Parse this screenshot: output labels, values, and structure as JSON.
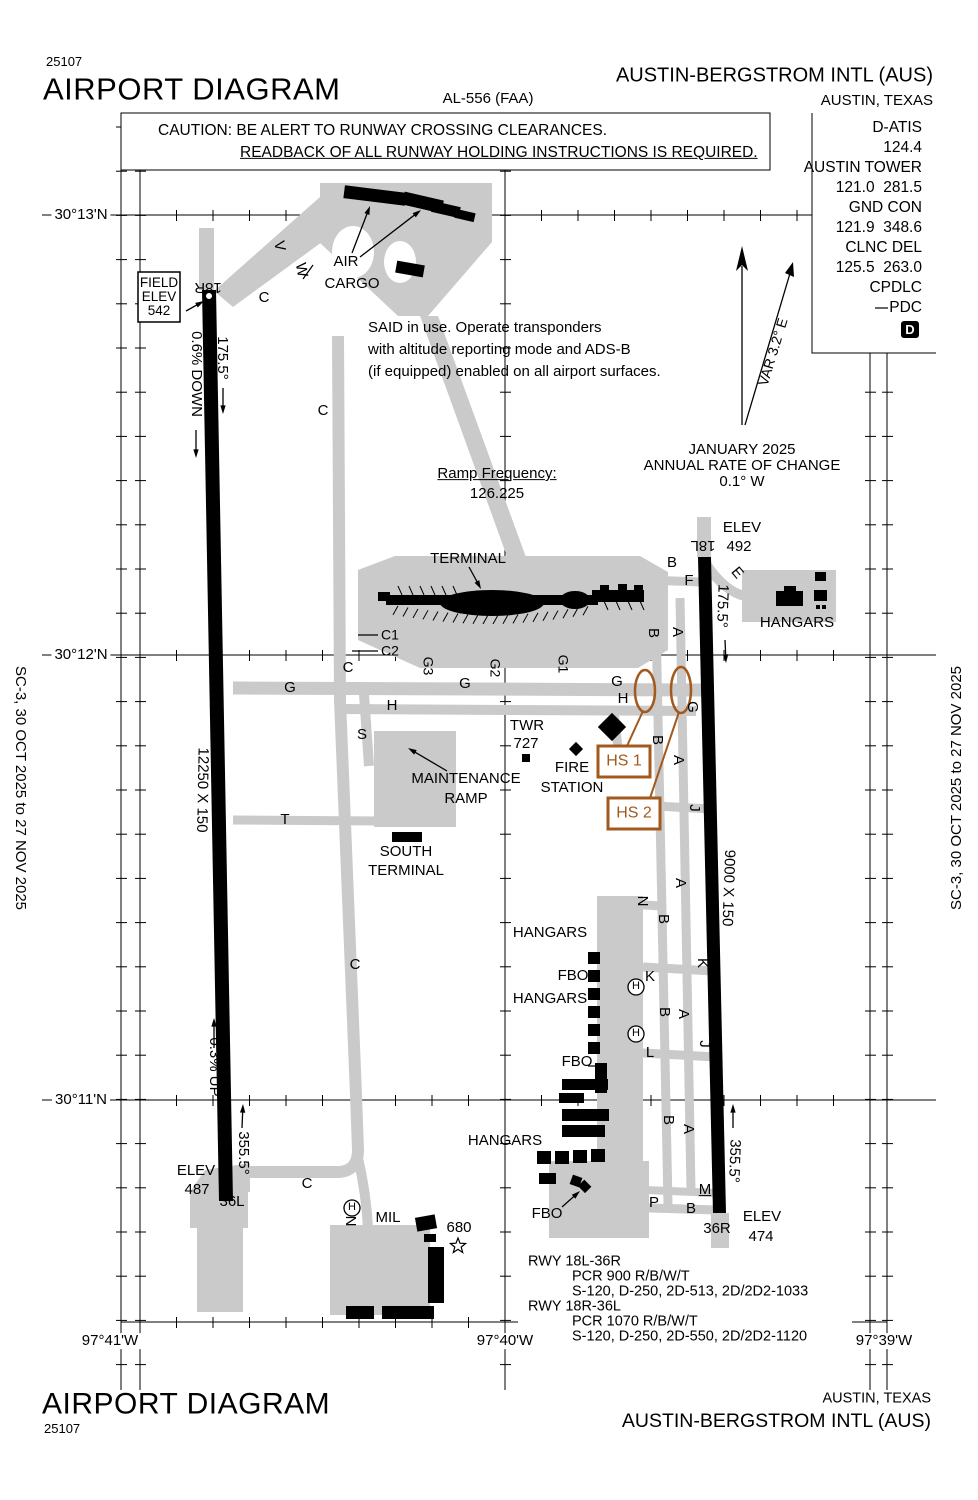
{
  "header": {
    "chart_number": "25107",
    "title": "AIRPORT DIAGRAM",
    "procedure_id": "AL-556 (FAA)",
    "airport_name": "AUSTIN-BERGSTROM INTL (AUS)",
    "city_state": "AUSTIN, TEXAS"
  },
  "footer": {
    "title": "AIRPORT DIAGRAM",
    "chart_number": "25107",
    "airport_name": "AUSTIN-BERGSTROM INTL (AUS)",
    "city_state": "AUSTIN, TEXAS"
  },
  "margins": {
    "left_edition": "SC-3, 30 OCT 2025 to 27 NOV 2025",
    "right_edition": "SC-3, 30 OCT 2025 to 27 NOV 2025"
  },
  "frequencies": {
    "lines": [
      "D-ATIS",
      "124.4",
      "AUSTIN TOWER",
      "121.0  281.5",
      "GND CON",
      "121.9  348.6",
      "CLNC DEL",
      "125.5  263.0",
      "CPDLC",
      "PDC"
    ]
  },
  "rwy_info": {
    "lines": [
      {
        "t": "RWY 18L-36R",
        "i": 0
      },
      {
        "t": "PCR 900 R/B/W/T",
        "i": 1
      },
      {
        "t": "S-120, D-250, 2D-513, 2D/2D2-1033",
        "i": 1
      },
      {
        "t": "RWY 18R-36L",
        "i": 0
      },
      {
        "t": "PCR 1070 R/B/W/T",
        "i": 1
      },
      {
        "t": "S-120, D-250, 2D-550, 2D/2D2-1120",
        "i": 1
      }
    ]
  },
  "colors": {
    "hotspot": "#a3581c",
    "taxiway_gray": "#cacaca",
    "black": "#000000"
  },
  "map": {
    "labels": [
      {
        "n": "lat-label-30-13n",
        "t": "30°13'N",
        "x": 81,
        "y": 215,
        "bg": 1
      },
      {
        "n": "lat-label-30-12n",
        "t": "30°12'N",
        "x": 81,
        "y": 655,
        "bg": 1
      },
      {
        "n": "lat-label-30-11n",
        "t": "30°11'N",
        "x": 81,
        "y": 1100,
        "bg": 1
      },
      {
        "n": "lon-label-97-41w",
        "t": "97°41'W",
        "x": 110,
        "y": 1341,
        "bg": 1
      },
      {
        "n": "lon-label-97-40w",
        "t": "97°40'W",
        "x": 505,
        "y": 1341,
        "bg": 1
      },
      {
        "n": "lon-label-97-39w",
        "t": "97°39'W",
        "x": 884,
        "y": 1341,
        "bg": 1
      },
      {
        "n": "caution-line-1",
        "t": "CAUTION: BE ALERT TO RUNWAY CROSSING CLEARANCES.",
        "x": 158,
        "y": 131,
        "a": "l",
        "fs": 15.5
      },
      {
        "n": "caution-line-2",
        "t": "READBACK OF ALL RUNWAY HOLDING INSTRUCTIONS IS REQUIRED.",
        "x": 240,
        "y": 153,
        "a": "l",
        "fs": 15.5,
        "u": 1
      },
      {
        "n": "pdc-d-letter",
        "t": "D",
        "x": 910,
        "y": 330,
        "fs": 13,
        "col": "#ffffff",
        "b": 1
      },
      {
        "n": "field-elev-line-1",
        "t": "FIELD",
        "x": 159,
        "y": 283,
        "fs": 13.5
      },
      {
        "n": "field-elev-line-2",
        "t": "ELEV",
        "x": 159,
        "y": 297,
        "fs": 13.5
      },
      {
        "n": "field-elev-line-3",
        "t": "542",
        "x": 159,
        "y": 311,
        "fs": 13.5
      },
      {
        "n": "rwy-end-18r",
        "t": "18R",
        "x": 208,
        "y": 287,
        "r": 180
      },
      {
        "n": "slope-label-06-down",
        "t": "0.6% DOWN",
        "x": 196,
        "y": 374,
        "r": 90
      },
      {
        "n": "hdg-label-175-5-west",
        "t": "175.5°",
        "x": 222,
        "y": 358,
        "r": 90
      },
      {
        "n": "air-cargo-line-1",
        "t": "AIR",
        "x": 346,
        "y": 262
      },
      {
        "n": "air-cargo-line-2",
        "t": "CARGO",
        "x": 352,
        "y": 284
      },
      {
        "n": "said-note-line-1",
        "t": "SAID in use. Operate transponders",
        "x": 368,
        "y": 328,
        "a": "l"
      },
      {
        "n": "said-note-line-2",
        "t": "with altitude reporting mode and ADS-B",
        "x": 368,
        "y": 350,
        "a": "l"
      },
      {
        "n": "said-note-line-3",
        "t": "(if equipped) enabled on all airport surfaces.",
        "x": 368,
        "y": 372,
        "a": "l"
      },
      {
        "n": "ramp-frequency-label",
        "t": "Ramp Frequency:",
        "x": 497,
        "y": 474,
        "u": 1
      },
      {
        "n": "ramp-frequency-value",
        "t": "126.225",
        "x": 497,
        "y": 494
      },
      {
        "n": "annual-change-line-1",
        "t": "JANUARY 2025",
        "x": 742,
        "y": 450
      },
      {
        "n": "annual-change-line-2",
        "t": "ANNUAL RATE OF CHANGE",
        "x": 742,
        "y": 466
      },
      {
        "n": "annual-change-line-3",
        "t": "0.1° W",
        "x": 742,
        "y": 482
      },
      {
        "n": "var-label",
        "t": "VAR 3.2° E",
        "x": 773,
        "y": 352,
        "r": -73,
        "fs": 14
      },
      {
        "n": "terminal-label",
        "t": "TERMINAL",
        "x": 468,
        "y": 559
      },
      {
        "n": "elev-18l-line-1",
        "t": "ELEV",
        "x": 742,
        "y": 528
      },
      {
        "n": "elev-18l-line-2",
        "t": "492",
        "x": 739,
        "y": 547
      },
      {
        "n": "rwy-end-18l",
        "t": "18L",
        "x": 703,
        "y": 545,
        "r": 180
      },
      {
        "n": "hdg-label-175-5-east",
        "t": "175.5°",
        "x": 722,
        "y": 606,
        "r": 92
      },
      {
        "n": "hangars-ne-label",
        "t": "HANGARS",
        "x": 797,
        "y": 623
      },
      {
        "n": "taxiway-label-v",
        "t": "V",
        "x": 279,
        "y": 246,
        "r": 80
      },
      {
        "n": "taxiway-label-w",
        "t": "W",
        "x": 301,
        "y": 270,
        "r": 80
      },
      {
        "n": "taxiway-label-c-1",
        "t": "C",
        "x": 264,
        "y": 298
      },
      {
        "n": "taxiway-label-c-2",
        "t": "C",
        "x": 323,
        "y": 411
      },
      {
        "n": "taxiway-label-c-3",
        "t": "C",
        "x": 348,
        "y": 668
      },
      {
        "n": "taxiway-label-c-4",
        "t": "C",
        "x": 355,
        "y": 965
      },
      {
        "n": "taxiway-label-c-5",
        "t": "C",
        "x": 307,
        "y": 1184
      },
      {
        "n": "taxiway-label-c1",
        "t": "C1",
        "x": 390,
        "y": 635,
        "fs": 14
      },
      {
        "n": "taxiway-label-c2",
        "t": "C2",
        "x": 390,
        "y": 651,
        "fs": 14
      },
      {
        "n": "taxiway-label-g3",
        "t": "G3",
        "x": 428,
        "y": 666,
        "r": 90,
        "fs": 14
      },
      {
        "n": "taxiway-label-g2",
        "t": "G2",
        "x": 495,
        "y": 668,
        "r": 90,
        "fs": 14
      },
      {
        "n": "taxiway-label-g1",
        "t": "G1",
        "x": 563,
        "y": 664,
        "r": 90,
        "fs": 14
      },
      {
        "n": "taxiway-label-g-1",
        "t": "G",
        "x": 290,
        "y": 688
      },
      {
        "n": "taxiway-label-g-2",
        "t": "G",
        "x": 465,
        "y": 684
      },
      {
        "n": "taxiway-label-g-3",
        "t": "G",
        "x": 617,
        "y": 682
      },
      {
        "n": "taxiway-label-g-4",
        "t": "G",
        "x": 692,
        "y": 707,
        "r": 90
      },
      {
        "n": "taxiway-label-h-1",
        "t": "H",
        "x": 392,
        "y": 706
      },
      {
        "n": "taxiway-label-h-2",
        "t": "H",
        "x": 623,
        "y": 699
      },
      {
        "n": "taxiway-label-s",
        "t": "S",
        "x": 362,
        "y": 735
      },
      {
        "n": "taxiway-label-t",
        "t": "T",
        "x": 285,
        "y": 820
      },
      {
        "n": "taxiway-label-b-1",
        "t": "B",
        "x": 672,
        "y": 563
      },
      {
        "n": "taxiway-label-f",
        "t": "F",
        "x": 689,
        "y": 581
      },
      {
        "n": "taxiway-label-e",
        "t": "E",
        "x": 737,
        "y": 573,
        "r": 50
      },
      {
        "n": "taxiway-label-b-2",
        "t": "B",
        "x": 653,
        "y": 633,
        "r": 90
      },
      {
        "n": "taxiway-label-a-1",
        "t": "A",
        "x": 677,
        "y": 632,
        "r": 90
      },
      {
        "n": "taxiway-label-b-3",
        "t": "B",
        "x": 657,
        "y": 740,
        "r": 90
      },
      {
        "n": "taxiway-label-a-2",
        "t": "A",
        "x": 678,
        "y": 760,
        "r": 90
      },
      {
        "n": "taxiway-label-j-1",
        "t": "J",
        "x": 694,
        "y": 808,
        "r": 90
      },
      {
        "n": "taxiway-label-a-3",
        "t": "A",
        "x": 680,
        "y": 883,
        "r": 90
      },
      {
        "n": "taxiway-label-n-1",
        "t": "N",
        "x": 642,
        "y": 901,
        "r": 90
      },
      {
        "n": "taxiway-label-b-4",
        "t": "B",
        "x": 663,
        "y": 919,
        "r": 90
      },
      {
        "n": "taxiway-label-k-1",
        "t": "K",
        "x": 702,
        "y": 963,
        "r": 90
      },
      {
        "n": "taxiway-label-k-2",
        "t": "K",
        "x": 650,
        "y": 977
      },
      {
        "n": "taxiway-label-b-5",
        "t": "B",
        "x": 664,
        "y": 1012,
        "r": 90
      },
      {
        "n": "taxiway-label-a-4",
        "t": "A",
        "x": 683,
        "y": 1014,
        "r": 90
      },
      {
        "n": "taxiway-label-j-2",
        "t": "J",
        "x": 704,
        "y": 1044,
        "r": 90
      },
      {
        "n": "taxiway-label-l",
        "t": "L",
        "x": 650,
        "y": 1053
      },
      {
        "n": "taxiway-label-b-6",
        "t": "B",
        "x": 668,
        "y": 1120,
        "r": 90
      },
      {
        "n": "taxiway-label-a-5",
        "t": "A",
        "x": 688,
        "y": 1129,
        "r": 90
      },
      {
        "n": "taxiway-label-n-2",
        "t": "N",
        "x": 350,
        "y": 1221,
        "r": 90
      },
      {
        "n": "taxiway-label-m",
        "t": "M",
        "x": 705,
        "y": 1190,
        "u": 1
      },
      {
        "n": "taxiway-label-p",
        "t": "P",
        "x": 654,
        "y": 1203
      },
      {
        "n": "taxiway-label-b-7",
        "t": "B",
        "x": 691,
        "y": 1209
      },
      {
        "n": "twr-label",
        "t": "TWR",
        "x": 527,
        "y": 726
      },
      {
        "n": "twr-elev",
        "t": "727",
        "x": 526,
        "y": 744
      },
      {
        "n": "fire-station-line-1",
        "t": "FIRE",
        "x": 572,
        "y": 768
      },
      {
        "n": "fire-station-line-2",
        "t": "STATION",
        "x": 572,
        "y": 788
      },
      {
        "n": "hotspot-1-label",
        "t": "HS 1",
        "x": 624,
        "y": 762,
        "fs": 16,
        "col": "#a3581c"
      },
      {
        "n": "hotspot-2-label",
        "t": "HS 2",
        "x": 634,
        "y": 814,
        "fs": 16,
        "col": "#a3581c"
      },
      {
        "n": "maintenance-ramp-line-1",
        "t": "MAINTENANCE",
        "x": 466,
        "y": 779
      },
      {
        "n": "maintenance-ramp-line-2",
        "t": "RAMP",
        "x": 466,
        "y": 799
      },
      {
        "n": "south-terminal-line-1",
        "t": "SOUTH",
        "x": 406,
        "y": 852
      },
      {
        "n": "south-terminal-line-2",
        "t": "TERMINAL",
        "x": 406,
        "y": 871
      },
      {
        "n": "rwy-dim-18r-36l",
        "t": "12250 X 150",
        "x": 202,
        "y": 790,
        "r": 91
      },
      {
        "n": "rwy-dim-18l-36r",
        "t": "9000 X 150",
        "x": 728,
        "y": 888,
        "r": 92
      },
      {
        "n": "hangars-east-label-1",
        "t": "HANGARS",
        "x": 550,
        "y": 933
      },
      {
        "n": "fbo-label-1",
        "t": "FBO",
        "x": 573,
        "y": 976
      },
      {
        "n": "hangars-east-label-2",
        "t": "HANGARS",
        "x": 550,
        "y": 999
      },
      {
        "n": "fbo-label-2",
        "t": "FBO",
        "x": 577,
        "y": 1062
      },
      {
        "n": "slope-label-03-up",
        "t": "0.3% UP",
        "x": 214,
        "y": 1067,
        "r": 90
      },
      {
        "n": "hdg-label-355-5-west",
        "t": "355.5°",
        "x": 243,
        "y": 1153,
        "r": 90
      },
      {
        "n": "hdg-label-355-5-east",
        "t": "355.5°",
        "x": 734,
        "y": 1161,
        "r": 92
      },
      {
        "n": "elev-36l-line-1",
        "t": "ELEV",
        "x": 196,
        "y": 1171
      },
      {
        "n": "elev-36l-line-2",
        "t": "487",
        "x": 197,
        "y": 1190
      },
      {
        "n": "rwy-end-36l",
        "t": "36L",
        "x": 232,
        "y": 1202
      },
      {
        "n": "mil-label",
        "t": "MIL",
        "x": 388,
        "y": 1218
      },
      {
        "n": "beacon-elev",
        "t": "680",
        "x": 459,
        "y": 1228
      },
      {
        "n": "hangars-south-label",
        "t": "HANGARS",
        "x": 505,
        "y": 1141
      },
      {
        "n": "fbo-label-3",
        "t": "FBO",
        "x": 547,
        "y": 1214
      },
      {
        "n": "rwy-end-36r",
        "t": "36R",
        "x": 717,
        "y": 1229
      },
      {
        "n": "elev-36r-line-1",
        "t": "ELEV",
        "x": 762,
        "y": 1217
      },
      {
        "n": "elev-36r-line-2",
        "t": "474",
        "x": 761,
        "y": 1237
      },
      {
        "n": "helipad-h-1",
        "t": "H",
        "x": 352,
        "y": 1208,
        "fs": 11
      },
      {
        "n": "helipad-h-2",
        "t": "H",
        "x": 636,
        "y": 987,
        "fs": 11
      },
      {
        "n": "helipad-h-3",
        "t": "H",
        "x": 636,
        "y": 1034,
        "fs": 11
      }
    ]
  }
}
